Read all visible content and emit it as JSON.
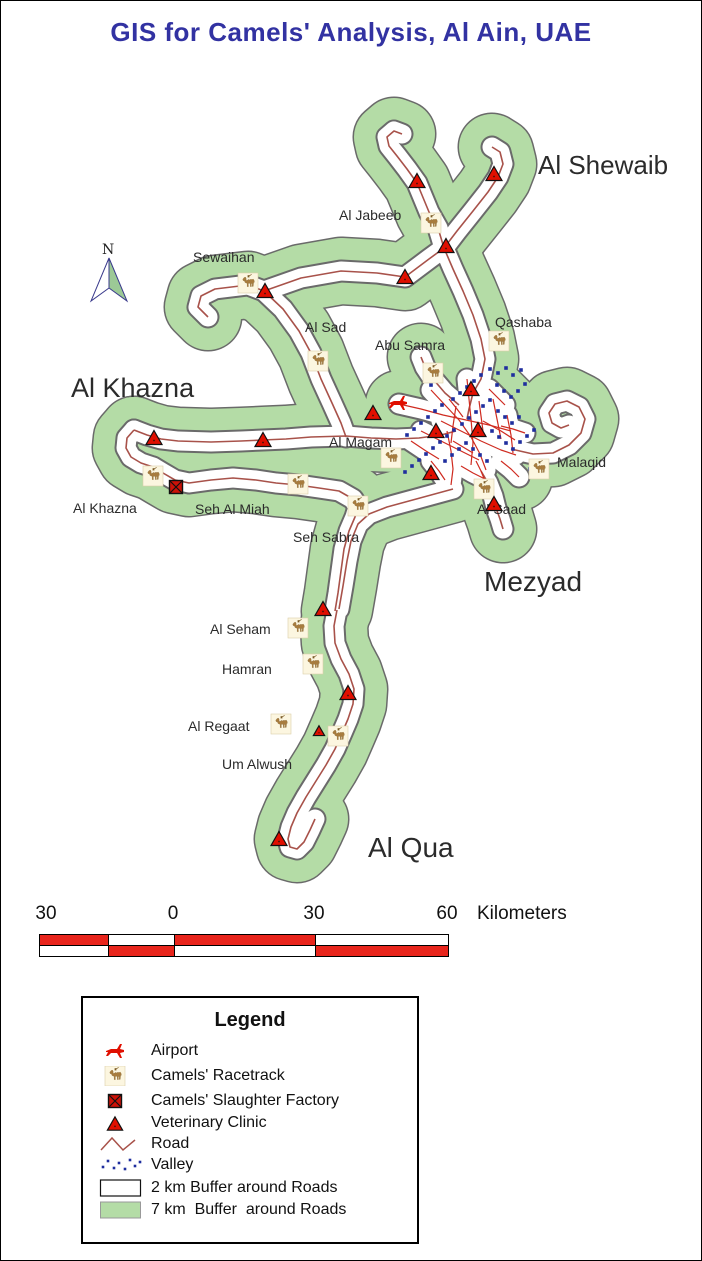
{
  "title": "GIS for Camels' Analysis, Al Ain, UAE",
  "north": {
    "label": "N"
  },
  "colors": {
    "title_blue": "#3232a2",
    "buffer_green": "#b4dca6",
    "outline": "#6a6a6a",
    "road": "#a8524a",
    "street": "#cf2b20",
    "valley": "#1f2e9e",
    "marker_red": "#e00f00",
    "camel": "#a87c3e",
    "camel_dark": "#7a5a26",
    "camel_bg": "#fcf6e0",
    "scale_red": "#e8251c",
    "arrow_green": "#9cc996",
    "arrow_outline": "#3a3a8c"
  },
  "scalebar": {
    "numbers": [
      "30",
      "0",
      "30",
      "60"
    ],
    "unit": "Kilometers",
    "segment_widths": [
      68,
      66,
      141,
      133
    ],
    "top_pattern": [
      "red",
      "white",
      "red",
      "white"
    ],
    "bottom_pattern": [
      "white",
      "red",
      "white",
      "red"
    ]
  },
  "legend": {
    "title": "Legend",
    "items": [
      {
        "icon": "airport",
        "label": "Airport"
      },
      {
        "icon": "racetrack",
        "label": "Camels' Racetrack"
      },
      {
        "icon": "slaughter",
        "label": "Camels' Slaughter Factory"
      },
      {
        "icon": "clinic",
        "label": "Veterinary Clinic"
      },
      {
        "icon": "road",
        "label": "Road"
      },
      {
        "icon": "valley",
        "label": "Valley"
      },
      {
        "icon": "buffer2",
        "label": "2 km Buffer around Roads"
      },
      {
        "icon": "buffer7",
        "label": "7 km  Buffer  around Roads"
      }
    ]
  },
  "map": {
    "labels": [
      {
        "t": "Al Shewaib",
        "x": 537,
        "y": 173,
        "s": 26
      },
      {
        "t": "Al Khazna",
        "x": 70,
        "y": 396,
        "s": 27
      },
      {
        "t": "Mezyad",
        "x": 483,
        "y": 590,
        "s": 28
      },
      {
        "t": "Al Qua",
        "x": 367,
        "y": 856,
        "s": 28
      },
      {
        "t": "Al Jabeeb",
        "x": 338,
        "y": 219,
        "s": 14
      },
      {
        "t": "Sewaihan",
        "x": 192,
        "y": 261,
        "s": 14
      },
      {
        "t": "Al Sad",
        "x": 304,
        "y": 331,
        "s": 14
      },
      {
        "t": "Qashaba",
        "x": 494,
        "y": 326,
        "s": 14
      },
      {
        "t": "Abu Samra",
        "x": 374,
        "y": 349,
        "s": 14
      },
      {
        "t": "Al Magam",
        "x": 328,
        "y": 446,
        "s": 14
      },
      {
        "t": "Malaqid",
        "x": 556,
        "y": 466,
        "s": 14
      },
      {
        "t": "Al Khazna",
        "x": 72,
        "y": 512,
        "s": 14
      },
      {
        "t": "Seh Al Miah",
        "x": 194,
        "y": 513,
        "s": 14
      },
      {
        "t": "Al Saad",
        "x": 476,
        "y": 513,
        "s": 14
      },
      {
        "t": "Seh Sabra",
        "x": 292,
        "y": 541,
        "s": 14
      },
      {
        "t": "Al Seham",
        "x": 209,
        "y": 633,
        "s": 14
      },
      {
        "t": "Hamran",
        "x": 221,
        "y": 673,
        "s": 14
      },
      {
        "t": "Al Regaat",
        "x": 187,
        "y": 730,
        "s": 14
      },
      {
        "t": "Um Alwush",
        "x": 221,
        "y": 768,
        "s": 14
      }
    ],
    "roads_main": [
      "207,316 197,306 200,295 214,288 247,284 263,290 300,277 340,270 376,272 404,276 428,258 443,247",
      "443,247 437,227 428,211 416,182 406,168 396,155 388,145 386,136 393,130 401,133",
      "443,247 456,230 472,210 487,191 497,176 502,163 499,151 491,146",
      "443,247 452,268 462,290 472,314 480,338 484,358 480,378 472,392 468,408 466,418",
      "263,290 282,308 298,330 310,352 320,378 331,402 340,422 345,436",
      "133,429 146,434 160,438 177,440 210,441 240,440 262,439 285,438 310,436 345,435 370,437 395,438 418,437 440,434 455,430",
      "133,429 126,437 125,447 130,456 140,462 152,466",
      "152,466 162,472 174,479 188,482 210,479 232,477 255,479 275,482 297,484 318,487 338,490 352,498 357,506 354,516 348,530 343,548 340,570 337,592 334,610",
      "452,488 430,494 408,500 386,506 368,513 357,523 350,540 346,560 342,585 338,608",
      "336,609 333,625 334,642 340,658 348,673 353,688 352,703 347,718 341,732 334,748 325,764 315,780 305,796 296,812 290,826 287,838 289,846 296,848 303,841 309,829 314,818",
      "510,448 532,453 552,452 568,444 580,432 584,418 578,406 566,400 554,403 548,412 551,422 560,427 568,424",
      "480,470 487,482 492,495 495,507 499,518 502,528",
      "458,404 444,392 432,378 424,366 420,356"
    ],
    "roads_city": [
      "398,403 420,408 442,414 465,419 488,424 510,430",
      "430,389 444,404 458,419 470,436 479,453 485,469",
      "466,378 468,398 470,418 472,442 470,464",
      "440,420 460,430 480,440 500,449 515,454",
      "420,430 440,440 460,450 478,459",
      "446,430 450,450 452,468 450,484",
      "482,420 500,430 514,439",
      "492,398 496,418 500,438",
      "506,414 510,434 512,452",
      "455,405 452,425 450,442",
      "478,400 480,415 482,430",
      "410,440 425,450 438,458",
      "460,465 472,472 484,478",
      "500,460 510,468 518,476",
      "488,388 496,396 504,404",
      "448,398 456,408 462,416",
      "500,425 512,428 524,432",
      "430,460 438,470 444,479",
      "452,440 462,446 472,452",
      "475,460 480,470 484,480"
    ],
    "valley_dots": [
      [
        489,
        368
      ],
      [
        497,
        372
      ],
      [
        505,
        367
      ],
      [
        512,
        374
      ],
      [
        520,
        369
      ],
      [
        480,
        374
      ],
      [
        473,
        380
      ],
      [
        466,
        386
      ],
      [
        459,
        392
      ],
      [
        452,
        398
      ],
      [
        496,
        384
      ],
      [
        503,
        390
      ],
      [
        510,
        396
      ],
      [
        517,
        390
      ],
      [
        524,
        383
      ],
      [
        441,
        404
      ],
      [
        434,
        410
      ],
      [
        427,
        416
      ],
      [
        420,
        422
      ],
      [
        413,
        428
      ],
      [
        406,
        434
      ],
      [
        489,
        399
      ],
      [
        482,
        405
      ],
      [
        475,
        411
      ],
      [
        468,
        417
      ],
      [
        461,
        423
      ],
      [
        497,
        410
      ],
      [
        504,
        416
      ],
      [
        511,
        422
      ],
      [
        518,
        416
      ],
      [
        453,
        429
      ],
      [
        446,
        435
      ],
      [
        439,
        441
      ],
      [
        432,
        447
      ],
      [
        425,
        453
      ],
      [
        418,
        459
      ],
      [
        411,
        465
      ],
      [
        404,
        471
      ],
      [
        491,
        430
      ],
      [
        498,
        436
      ],
      [
        505,
        442
      ],
      [
        512,
        448
      ],
      [
        519,
        441
      ],
      [
        526,
        435
      ],
      [
        533,
        429
      ],
      [
        465,
        442
      ],
      [
        458,
        448
      ],
      [
        451,
        454
      ],
      [
        444,
        460
      ],
      [
        472,
        448
      ],
      [
        479,
        454
      ],
      [
        486,
        460
      ],
      [
        529,
        468
      ],
      [
        536,
        462
      ],
      [
        430,
        384
      ],
      [
        437,
        378
      ]
    ],
    "markers": {
      "airports": [
        [
          397,
          402
        ]
      ],
      "slaughter_factories": [
        [
          175,
          486
        ]
      ],
      "clinics": [
        [
          416,
          180,
          1
        ],
        [
          493,
          173,
          1
        ],
        [
          445,
          245,
          1
        ],
        [
          404,
          276,
          1
        ],
        [
          264,
          290,
          1
        ],
        [
          470,
          388,
          1
        ],
        [
          372,
          412,
          1
        ],
        [
          435,
          430,
          1
        ],
        [
          477,
          429,
          1
        ],
        [
          153,
          437,
          1
        ],
        [
          262,
          439,
          1
        ],
        [
          430,
          472,
          1
        ],
        [
          493,
          503,
          1
        ],
        [
          322,
          608,
          1
        ],
        [
          347,
          692,
          1
        ],
        [
          318,
          730,
          0.7
        ],
        [
          278,
          838,
          1
        ]
      ],
      "racetracks": [
        [
          430,
          222
        ],
        [
          247,
          282
        ],
        [
          317,
          360
        ],
        [
          498,
          340
        ],
        [
          432,
          372
        ],
        [
          390,
          457
        ],
        [
          152,
          475
        ],
        [
          297,
          483
        ],
        [
          357,
          505
        ],
        [
          538,
          468
        ],
        [
          483,
          488
        ],
        [
          297,
          627
        ],
        [
          312,
          663
        ],
        [
          280,
          723
        ],
        [
          337,
          735
        ]
      ]
    }
  }
}
